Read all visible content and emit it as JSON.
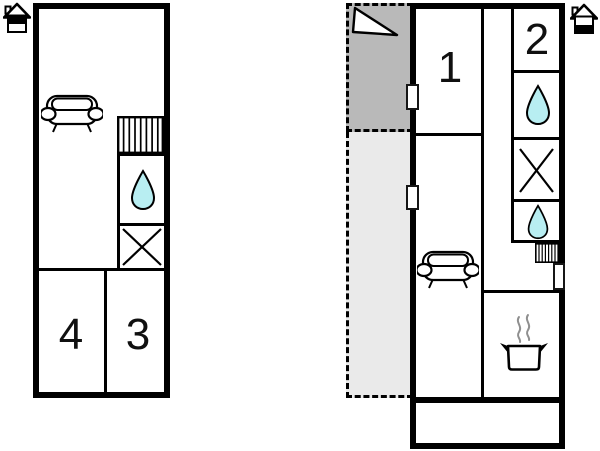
{
  "colors": {
    "wall": "#000000",
    "water": "#b8eef2",
    "balcony_dark": "#b9b9b9",
    "balcony_light": "#eaeaea",
    "background": "#ffffff",
    "steam": "#8f8f8f"
  },
  "plans": {
    "left": {
      "id": "upper-floor-plan",
      "rooms": [
        {
          "label": "4"
        },
        {
          "label": "3"
        }
      ],
      "icons": [
        "house-upper-floor-icon",
        "sofa-icon",
        "stairs-icon",
        "water-drop-icon",
        "window-x-icon"
      ]
    },
    "right": {
      "id": "ground-floor-plan",
      "rooms": [
        {
          "label": "1"
        },
        {
          "label": "2"
        }
      ],
      "icons": [
        "house-lower-floor-icon",
        "north-arrow-icon",
        "sofa-icon",
        "stairs-icon",
        "water-drop-icon",
        "window-x-icon",
        "cooking-pot-icon",
        "door-marker"
      ]
    }
  }
}
